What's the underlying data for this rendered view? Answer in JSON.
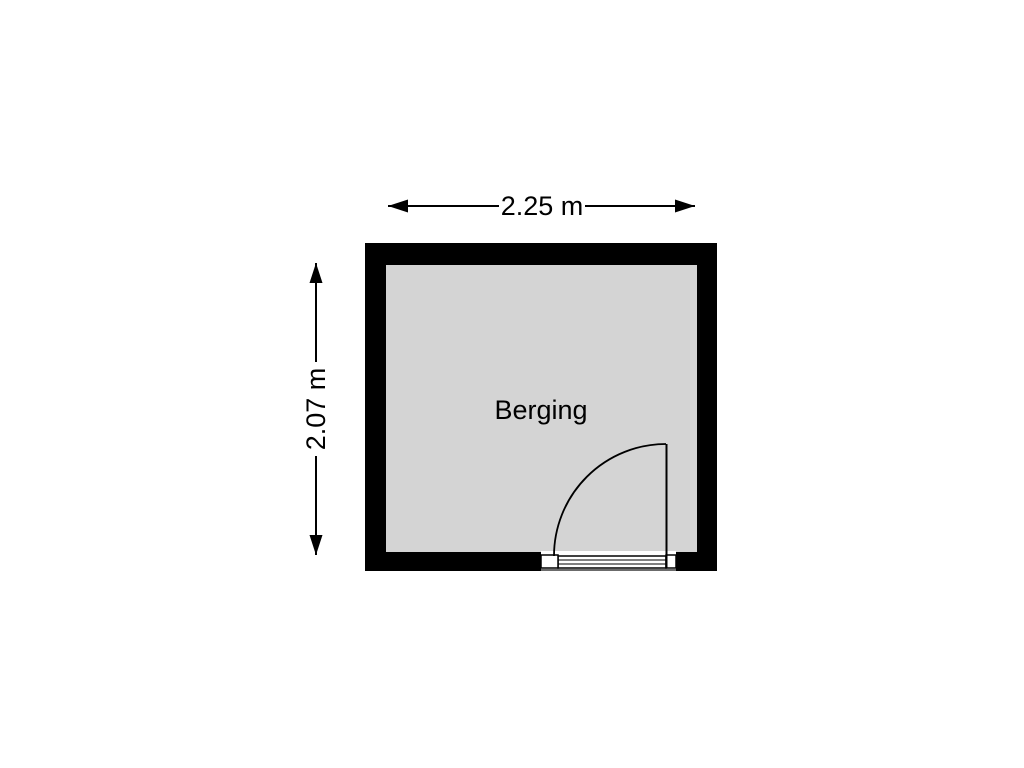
{
  "floorplan": {
    "room": {
      "label": "Berging"
    },
    "dimensions": {
      "width": {
        "label": "2.25 m"
      },
      "height": {
        "label": "2.07 m"
      }
    },
    "colors": {
      "wall": "#000000",
      "floor": "#d4d4d4",
      "background": "#ffffff",
      "line": "#000000",
      "text": "#000000"
    }
  }
}
